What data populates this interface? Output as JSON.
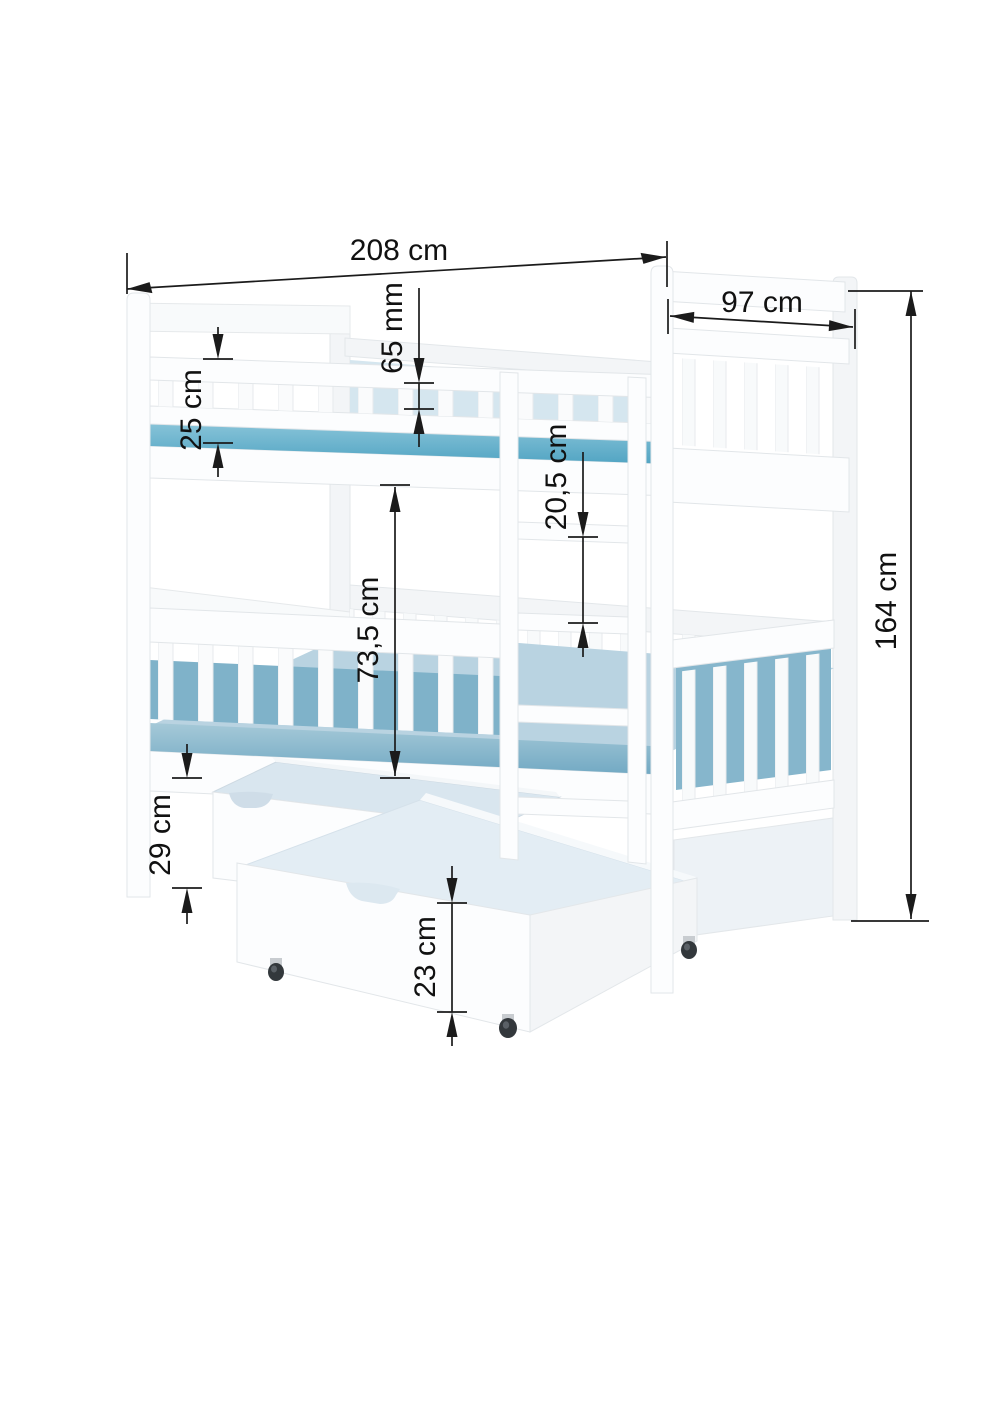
{
  "diagram": {
    "dims": {
      "bed_length": "208 cm",
      "bed_depth": "97 cm",
      "guard_rail_gap": "65 mm",
      "guard_above_mattress": "25 cm",
      "ladder_step_spacing": "20,5 cm",
      "clearance_between_bunks": "73,5 cm",
      "bed_height": "164 cm",
      "underbed_height": "29 cm",
      "drawer_height": "23 cm"
    },
    "colors": {
      "mattress_top": "#4fa3c2",
      "mattress_pale": "#b9d3e1",
      "frame": "#fcfdfe",
      "drawer_interior": "#e3edf4",
      "dimension_line": "#1b1b1b",
      "background": "#ffffff"
    }
  }
}
